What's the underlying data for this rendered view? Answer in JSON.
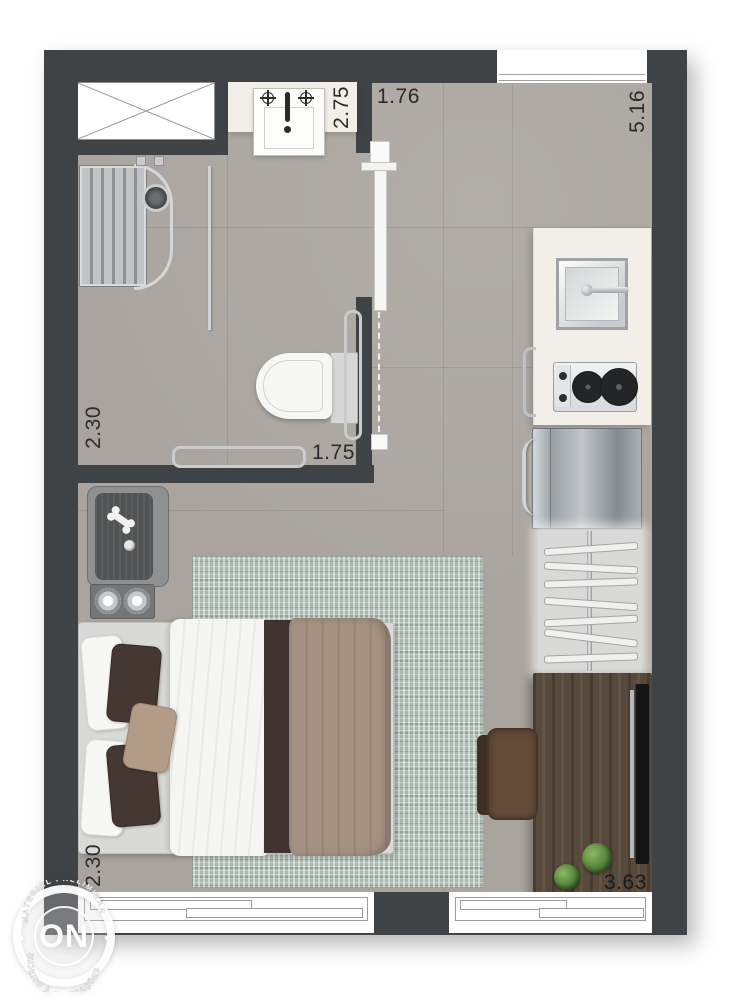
{
  "watermark": {
    "logo": "ON",
    "arc_top": "MATERIAL PRELIMINAR",
    "arc_bottom": "SUJEITO À ALTERAÇÕES"
  },
  "dimensions": {
    "bathroom_width_top": "2.75",
    "hall_width_top": "1.76",
    "living_length_right": "5.16",
    "bathroom_depth_left": "2.30",
    "bathroom_width_bottom": "1.75",
    "bedroom_depth_left": "2.30",
    "living_width_bottom": "3.63"
  },
  "colors": {
    "wall": "#404346",
    "floor": "#a9a49e",
    "counter": "#f2efe8",
    "rug": "#a9b8af",
    "wood": "#57493b",
    "dark_bedding": "#3e3330",
    "taupe": "#a59181",
    "label": "#2b2b2b"
  }
}
